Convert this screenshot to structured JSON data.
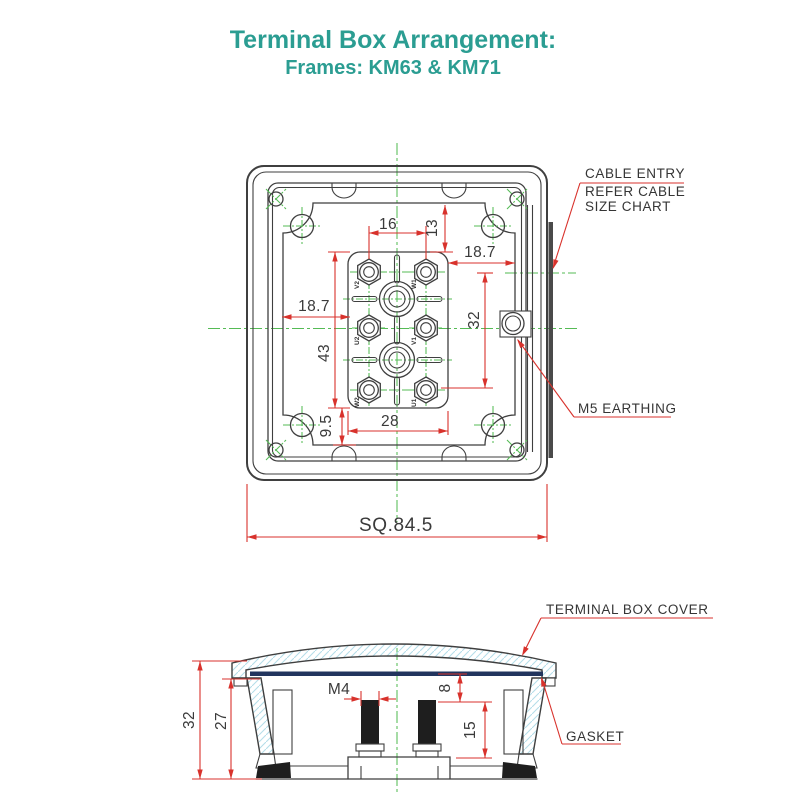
{
  "title": {
    "line1": "Terminal Box Arrangement:",
    "line2": "Frames: KM63 & KM71"
  },
  "top_view": {
    "dims": {
      "stud_pitch": "16",
      "top_offset": "13",
      "right_offset": "18.7",
      "left_offset": "18.7",
      "entry_height": "32",
      "plate_height": "43",
      "plate_width": "28",
      "bottom_offset": "9.5",
      "overall_square": "SQ.84.5"
    },
    "terminals": [
      "V2",
      "W1",
      "U2",
      "V1",
      "W2",
      "U1"
    ],
    "cable_entry_label": [
      "CABLE ENTRY",
      "REFER CABLE",
      "SIZE CHART"
    ],
    "earthing_label": "M5 EARTHING"
  },
  "side_view": {
    "dims": {
      "overall_height": "32",
      "inner_height": "27",
      "thread": "M4",
      "stud_top_offset": "8",
      "stud_length": "15"
    },
    "cover_label": "TERMINAL BOX COVER",
    "gasket_label": "GASKET"
  },
  "colors": {
    "title": "#2b9d92",
    "dimension_red": "#d8322c",
    "centerline_green": "#55bb55",
    "line_dark": "#3f3f3f",
    "hatch_blue": "#b5dde9",
    "gasket_navy": "#22355e"
  }
}
